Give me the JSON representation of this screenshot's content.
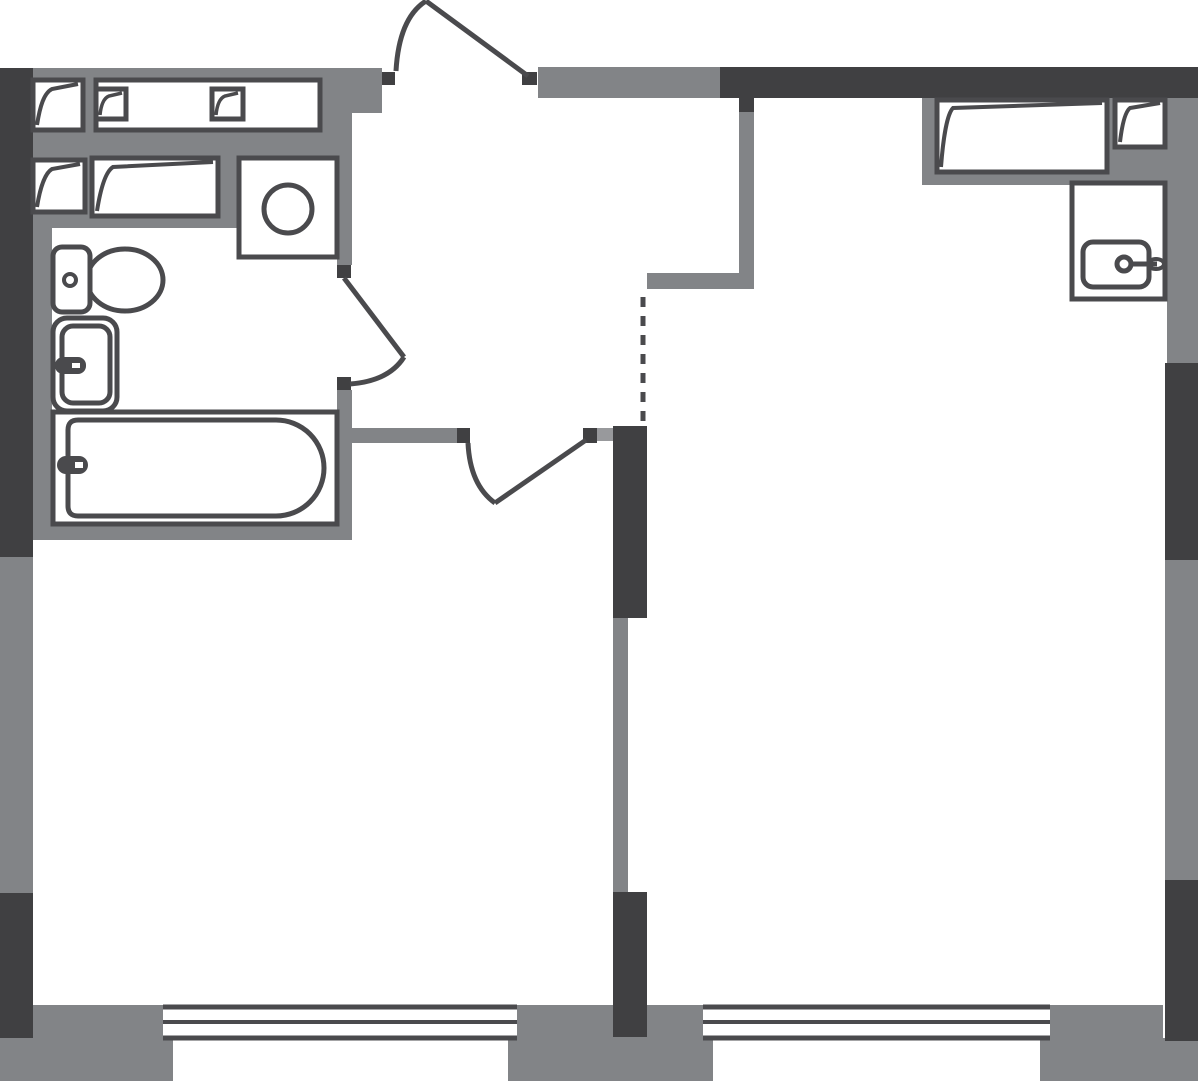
{
  "canvas": {
    "width": 1198,
    "height": 1081,
    "background": "#ffffff"
  },
  "colors": {
    "wall_gray": "#828487",
    "wall_dark": "#404042",
    "outline": "#4a4a4d",
    "light_block": "#98999c",
    "white": "#ffffff",
    "none": "none"
  },
  "shapes": [
    {
      "name": "wall-top-left-band",
      "type": "rect",
      "x": 33,
      "y": 68,
      "w": 349,
      "h": 31,
      "fill": "wall_gray"
    },
    {
      "name": "wall-entry-jamb-stub",
      "type": "rect",
      "x": 352,
      "y": 99,
      "w": 30,
      "h": 14,
      "fill": "wall_gray"
    },
    {
      "name": "wall-tech-zone",
      "type": "rect",
      "x": 33,
      "y": 99,
      "w": 319,
      "h": 129,
      "fill": "wall_gray"
    },
    {
      "name": "wall-bath-left",
      "type": "rect",
      "x": 33,
      "y": 228,
      "w": 19,
      "h": 295,
      "fill": "wall_gray"
    },
    {
      "name": "wall-bath-bottom",
      "type": "rect",
      "x": 33,
      "y": 521,
      "w": 319,
      "h": 19,
      "fill": "wall_gray"
    },
    {
      "name": "wall-bath-right-upper",
      "type": "rect",
      "x": 337,
      "y": 99,
      "w": 15,
      "h": 166,
      "fill": "wall_gray"
    },
    {
      "name": "wall-bath-right-lower",
      "type": "rect",
      "x": 337,
      "y": 390,
      "w": 15,
      "h": 133,
      "fill": "wall_gray"
    },
    {
      "name": "wall-left-mid",
      "type": "rect",
      "x": 0,
      "y": 557,
      "w": 33,
      "h": 336,
      "fill": "wall_gray"
    },
    {
      "name": "wall-leftroom-top",
      "type": "rect",
      "x": 352,
      "y": 428,
      "w": 105,
      "h": 15,
      "fill": "wall_gray"
    },
    {
      "name": "wall-hall-right",
      "type": "rect",
      "x": 739,
      "y": 112,
      "w": 15,
      "h": 177,
      "fill": "wall_gray"
    },
    {
      "name": "wall-nook-top",
      "type": "rect",
      "x": 647,
      "y": 273,
      "w": 107,
      "h": 16,
      "fill": "wall_gray"
    },
    {
      "name": "wall-right-upper",
      "type": "rect",
      "x": 1167,
      "y": 98,
      "w": 31,
      "h": 265,
      "fill": "wall_gray"
    },
    {
      "name": "wall-right-mid",
      "type": "rect",
      "x": 1165,
      "y": 560,
      "w": 33,
      "h": 320,
      "fill": "wall_gray"
    },
    {
      "name": "wall-partition-mid",
      "type": "rect",
      "x": 613,
      "y": 618,
      "w": 15,
      "h": 274,
      "fill": "wall_gray"
    },
    {
      "name": "wall-top-center-band",
      "type": "rect",
      "x": 538,
      "y": 67,
      "w": 182,
      "h": 31,
      "fill": "wall_gray"
    },
    {
      "name": "wardrobe-zone",
      "type": "rect",
      "x": 922,
      "y": 98,
      "w": 245,
      "h": 87,
      "fill": "wall_gray"
    },
    {
      "name": "pier-bottom-left-upper",
      "type": "rect",
      "x": 33,
      "y": 1005,
      "w": 130,
      "h": 33,
      "fill": "wall_gray"
    },
    {
      "name": "pier-bottom-left",
      "type": "rect",
      "x": 0,
      "y": 1038,
      "w": 173,
      "h": 43,
      "fill": "wall_gray"
    },
    {
      "name": "pier-bottom-center-upper",
      "type": "rect",
      "x": 517,
      "y": 1005,
      "w": 186,
      "h": 33,
      "fill": "wall_gray"
    },
    {
      "name": "pier-bottom-center",
      "type": "rect",
      "x": 508,
      "y": 1037,
      "w": 205,
      "h": 44,
      "fill": "wall_gray"
    },
    {
      "name": "pier-bottom-right-upper",
      "type": "rect",
      "x": 1050,
      "y": 1005,
      "w": 113,
      "h": 33,
      "fill": "wall_gray"
    },
    {
      "name": "pier-bottom-right",
      "type": "rect",
      "x": 1040,
      "y": 1038,
      "w": 158,
      "h": 43,
      "fill": "wall_gray"
    },
    {
      "name": "wall-left-upper",
      "type": "rect",
      "x": 0,
      "y": 68,
      "w": 33,
      "h": 489,
      "fill": "wall_dark"
    },
    {
      "name": "wall-left-lower",
      "type": "rect",
      "x": 0,
      "y": 893,
      "w": 33,
      "h": 145,
      "fill": "wall_dark"
    },
    {
      "name": "wall-top-right",
      "type": "rect",
      "x": 720,
      "y": 67,
      "w": 478,
      "h": 31,
      "fill": "wall_dark"
    },
    {
      "name": "wall-right-uppermid",
      "type": "rect",
      "x": 1165,
      "y": 363,
      "w": 33,
      "h": 197,
      "fill": "wall_dark"
    },
    {
      "name": "wall-right-lower",
      "type": "rect",
      "x": 1165,
      "y": 880,
      "w": 33,
      "h": 161,
      "fill": "wall_dark"
    },
    {
      "name": "wall-partition-upper",
      "type": "rect",
      "x": 613,
      "y": 426,
      "w": 34,
      "h": 192,
      "fill": "wall_dark"
    },
    {
      "name": "wall-partition-lower",
      "type": "rect",
      "x": 613,
      "y": 892,
      "w": 34,
      "h": 145,
      "fill": "wall_dark"
    },
    {
      "name": "wall-hall-right-cap",
      "type": "rect",
      "x": 739,
      "y": 98,
      "w": 15,
      "h": 14,
      "fill": "wall_dark"
    },
    {
      "name": "entry-door-jamb-left",
      "type": "rect",
      "x": 382,
      "y": 72,
      "w": 13,
      "h": 13,
      "fill": "wall_dark"
    },
    {
      "name": "entry-door-jamb-right",
      "type": "rect",
      "x": 522,
      "y": 72,
      "w": 15,
      "h": 13,
      "fill": "wall_dark"
    },
    {
      "name": "bath-door-jamb-top",
      "type": "rect",
      "x": 337,
      "y": 265,
      "w": 14,
      "h": 13,
      "fill": "wall_dark"
    },
    {
      "name": "bath-door-jamb-bottom",
      "type": "rect",
      "x": 337,
      "y": 377,
      "w": 14,
      "h": 13,
      "fill": "wall_dark"
    },
    {
      "name": "room-door-jamb-left",
      "type": "rect",
      "x": 457,
      "y": 428,
      "w": 13,
      "h": 15,
      "fill": "wall_dark"
    },
    {
      "name": "room-door-jamb-right",
      "type": "rect",
      "x": 583,
      "y": 428,
      "w": 14,
      "h": 15,
      "fill": "wall_dark"
    },
    {
      "name": "room-door-block",
      "type": "rect",
      "x": 597,
      "y": 428,
      "w": 16,
      "h": 13,
      "fill": "light_block"
    },
    {
      "name": "vent-shaft-a",
      "type": "rect",
      "x": 33,
      "y": 80,
      "w": 50,
      "h": 50,
      "fill": "white",
      "stroke": "outline",
      "sw": 5
    },
    {
      "name": "vent-shaft-a-flap",
      "type": "path",
      "d": "M37,125 C40,106 44,93 52,89 L78,84",
      "fill": "none",
      "stroke": "outline",
      "sw": 4
    },
    {
      "name": "counter-top",
      "type": "rect",
      "x": 96,
      "y": 80,
      "w": 224,
      "h": 50,
      "fill": "white",
      "stroke": "outline",
      "sw": 5
    },
    {
      "name": "counter-square-1",
      "type": "rect",
      "x": 96,
      "y": 89,
      "w": 30,
      "h": 30,
      "fill": "white",
      "stroke": "outline",
      "sw": 5
    },
    {
      "name": "counter-square-1-flap",
      "type": "path",
      "d": "M100,115 C101,105 104,98 109,96 L122,93",
      "fill": "none",
      "stroke": "outline",
      "sw": 3.5
    },
    {
      "name": "counter-square-2",
      "type": "rect",
      "x": 212,
      "y": 89,
      "w": 31,
      "h": 30,
      "fill": "white",
      "stroke": "outline",
      "sw": 5
    },
    {
      "name": "counter-square-2-flap",
      "type": "path",
      "d": "M216,115 C217,105 220,98 225,96 L238,93",
      "fill": "none",
      "stroke": "outline",
      "sw": 3.5
    },
    {
      "name": "vent-shaft-b",
      "type": "rect",
      "x": 33,
      "y": 160,
      "w": 52,
      "h": 52,
      "fill": "white",
      "stroke": "outline",
      "sw": 5
    },
    {
      "name": "vent-shaft-b-flap",
      "type": "path",
      "d": "M37,207 C40,188 45,173 52,169 L80,164",
      "fill": "none",
      "stroke": "outline",
      "sw": 4
    },
    {
      "name": "cabinet-left",
      "type": "rect",
      "x": 92,
      "y": 158,
      "w": 126,
      "h": 58,
      "fill": "white",
      "stroke": "outline",
      "sw": 5
    },
    {
      "name": "cabinet-left-flap",
      "type": "path",
      "d": "M97,211 C100,192 105,172 113,167 L213,162",
      "fill": "none",
      "stroke": "outline",
      "sw": 4
    },
    {
      "name": "washing-machine",
      "type": "rect",
      "x": 239,
      "y": 158,
      "w": 98,
      "h": 99,
      "fill": "white",
      "stroke": "outline",
      "sw": 5
    },
    {
      "name": "washing-machine-drum",
      "type": "circle",
      "cx": 288,
      "cy": 209,
      "r": 24,
      "fill": "none",
      "stroke": "outline",
      "sw": 5
    },
    {
      "name": "toilet-bowl",
      "type": "ellipse",
      "cx": 125,
      "cy": 280,
      "rx": 38,
      "ry": 31,
      "fill": "white",
      "stroke": "outline",
      "sw": 5
    },
    {
      "name": "toilet-tank",
      "type": "rect",
      "x": 53,
      "y": 247,
      "w": 37,
      "h": 65,
      "rx": 9,
      "fill": "white",
      "stroke": "outline",
      "sw": 5
    },
    {
      "name": "toilet-flush-button",
      "type": "circle",
      "cx": 70,
      "cy": 280,
      "r": 6,
      "fill": "white",
      "stroke": "outline",
      "sw": 4
    },
    {
      "name": "basin-outer",
      "type": "rect",
      "x": 53,
      "y": 318,
      "w": 64,
      "h": 93,
      "rx": 14,
      "fill": "white",
      "stroke": "outline",
      "sw": 5
    },
    {
      "name": "basin-inner",
      "type": "rect",
      "x": 62,
      "y": 326,
      "w": 48,
      "h": 77,
      "rx": 11,
      "fill": "none",
      "stroke": "outline",
      "sw": 5
    },
    {
      "name": "basin-faucet",
      "type": "rect",
      "x": 55,
      "y": 357,
      "w": 31,
      "h": 17,
      "rx": 8,
      "fill": "outline"
    },
    {
      "name": "basin-faucet-slit",
      "type": "rect",
      "x": 72,
      "y": 363,
      "w": 8,
      "h": 5,
      "fill": "white"
    },
    {
      "name": "bathtub-outer",
      "type": "rect",
      "x": 53,
      "y": 412,
      "w": 284,
      "h": 112,
      "fill": "white",
      "stroke": "outline",
      "sw": 5
    },
    {
      "name": "bathtub-inner",
      "type": "path",
      "d": "M78,420 L276,420 A48,48 0 0 1 276,516 L78,516 Q68,516 68,506 L68,430 Q68,420 78,420 Z",
      "fill": "none",
      "stroke": "outline",
      "sw": 5
    },
    {
      "name": "bathtub-faucet",
      "type": "rect",
      "x": 57,
      "y": 456,
      "w": 31,
      "h": 18,
      "rx": 9,
      "fill": "outline"
    },
    {
      "name": "bathtub-faucet-slit",
      "type": "rect",
      "x": 75,
      "y": 462,
      "w": 8,
      "h": 6,
      "fill": "white"
    },
    {
      "name": "wardrobe",
      "type": "rect",
      "x": 937,
      "y": 100,
      "w": 170,
      "h": 72,
      "fill": "white",
      "stroke": "outline",
      "sw": 5
    },
    {
      "name": "wardrobe-flap",
      "type": "path",
      "d": "M941,167 C943,140 947,114 953,108 L1102,103",
      "fill": "none",
      "stroke": "outline",
      "sw": 4
    },
    {
      "name": "vent-shaft-c",
      "type": "rect",
      "x": 1115,
      "y": 100,
      "w": 50,
      "h": 47,
      "fill": "white",
      "stroke": "outline",
      "sw": 5
    },
    {
      "name": "vent-shaft-c-flap",
      "type": "path",
      "d": "M1120,142 C1122,125 1125,112 1130,108 L1160,103",
      "fill": "none",
      "stroke": "outline",
      "sw": 4
    },
    {
      "name": "kitchen-sink-cabinet",
      "type": "rect",
      "x": 1072,
      "y": 183,
      "w": 93,
      "h": 116,
      "fill": "white",
      "stroke": "outline",
      "sw": 5
    },
    {
      "name": "kitchen-sink-bowl",
      "type": "rect",
      "x": 1083,
      "y": 242,
      "w": 66,
      "h": 45,
      "rx": 10,
      "fill": "none",
      "stroke": "outline",
      "sw": 5
    },
    {
      "name": "kitchen-faucet-stem",
      "type": "line",
      "x1": 1130,
      "y1": 264,
      "x2": 1157,
      "y2": 264,
      "stroke": "outline",
      "sw": 5
    },
    {
      "name": "kitchen-faucet-tip",
      "type": "ellipse",
      "cx": 1156,
      "cy": 264,
      "rx": 8,
      "ry": 5,
      "fill": "none",
      "stroke": "outline",
      "sw": 4
    },
    {
      "name": "kitchen-faucet-knob",
      "type": "circle",
      "cx": 1124,
      "cy": 264,
      "r": 7,
      "fill": "white",
      "stroke": "outline",
      "sw": 5
    },
    {
      "name": "entry-door-arc",
      "type": "path",
      "d": "M396,71 Q399,18 426,1",
      "fill": "none",
      "stroke": "outline",
      "sw": 5
    },
    {
      "name": "entry-door-leaf",
      "type": "line",
      "x1": 426,
      "y1": 1,
      "x2": 528,
      "y2": 76,
      "stroke": "outline",
      "sw": 5
    },
    {
      "name": "bath-door-leaf",
      "type": "line",
      "x1": 344,
      "y1": 278,
      "x2": 404,
      "y2": 357,
      "stroke": "outline",
      "sw": 5
    },
    {
      "name": "bath-door-arc",
      "type": "path",
      "d": "M404,357 Q389,381 350,384",
      "fill": "none",
      "stroke": "outline",
      "sw": 5
    },
    {
      "name": "room-door-leaf",
      "type": "line",
      "x1": 586,
      "y1": 440,
      "x2": 495,
      "y2": 503,
      "stroke": "outline",
      "sw": 5
    },
    {
      "name": "room-door-arc",
      "type": "path",
      "d": "M468,443 Q470,485 495,503",
      "fill": "none",
      "stroke": "outline",
      "sw": 5
    },
    {
      "name": "opening-dashed-line",
      "type": "line",
      "x1": 643,
      "y1": 297,
      "x2": 643,
      "y2": 427,
      "stroke": "outline",
      "sw": 5,
      "dash": "10 9"
    },
    {
      "name": "window-left-outer-line",
      "type": "line",
      "x1": 163,
      "y1": 1007,
      "x2": 517,
      "y2": 1007,
      "stroke": "outline",
      "sw": 5
    },
    {
      "name": "window-left-glass-line",
      "type": "line",
      "x1": 163,
      "y1": 1022,
      "x2": 517,
      "y2": 1022,
      "stroke": "outline",
      "sw": 4
    },
    {
      "name": "window-left-inner-line",
      "type": "line",
      "x1": 163,
      "y1": 1038,
      "x2": 517,
      "y2": 1038,
      "stroke": "outline",
      "sw": 5
    },
    {
      "name": "window-right-outer-line",
      "type": "line",
      "x1": 703,
      "y1": 1007,
      "x2": 1050,
      "y2": 1007,
      "stroke": "outline",
      "sw": 5
    },
    {
      "name": "window-right-glass-line",
      "type": "line",
      "x1": 703,
      "y1": 1022,
      "x2": 1050,
      "y2": 1022,
      "stroke": "outline",
      "sw": 4
    },
    {
      "name": "window-right-inner-line",
      "type": "line",
      "x1": 703,
      "y1": 1038,
      "x2": 1050,
      "y2": 1038,
      "stroke": "outline",
      "sw": 5
    }
  ]
}
